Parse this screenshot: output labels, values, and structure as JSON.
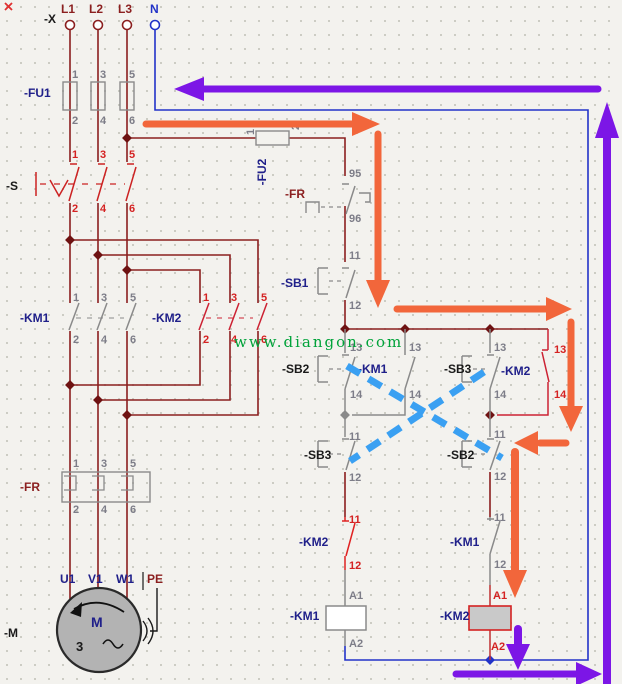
{
  "supply": {
    "x_label": "-X",
    "l1": "L1",
    "l2": "L2",
    "l3": "L3",
    "n": "N"
  },
  "fu1": {
    "label": "-FU1",
    "pins_top": [
      "1",
      "3",
      "5"
    ],
    "pins_bottom": [
      "2",
      "4",
      "6"
    ]
  },
  "s": {
    "label": "-S",
    "pins_top": [
      "1",
      "3",
      "5"
    ],
    "pins_bottom": [
      "2",
      "4",
      "6"
    ]
  },
  "km1_main": {
    "label": "-KM1",
    "pins_top": [
      "1",
      "3",
      "5"
    ],
    "pins_bottom": [
      "2",
      "4",
      "6"
    ]
  },
  "km2_main": {
    "label": "-KM2",
    "pins_top": [
      "1",
      "3",
      "5"
    ],
    "pins_bottom": [
      "2",
      "4",
      "6"
    ]
  },
  "fr_main": {
    "label": "-FR",
    "pins_top": [
      "1",
      "3",
      "5"
    ],
    "pins_bottom": [
      "2",
      "4",
      "6"
    ]
  },
  "motor": {
    "label": "-M",
    "letter": "M",
    "phase": "3",
    "u1": "U1",
    "v1": "V1",
    "w1": "W1",
    "pe": "PE"
  },
  "fu2": {
    "label": "-FU2",
    "pin1": "1",
    "pin2": "2"
  },
  "fr_nc": {
    "label": "-FR",
    "top": "95",
    "bottom": "96"
  },
  "sb1": {
    "label": "-SB1",
    "top": "11",
    "bottom": "12"
  },
  "sb2_no": {
    "label": "-SB2",
    "top": "13",
    "bottom": "14"
  },
  "km1_aux": {
    "label": "-KM1",
    "top": "13",
    "bottom": "14"
  },
  "sb3_no": {
    "label": "-SB3",
    "top": "13",
    "bottom": "14"
  },
  "km2_aux": {
    "label": "-KM2",
    "top": "13",
    "bottom": "14"
  },
  "sb3_nc": {
    "label": "-SB3",
    "top": "11",
    "bottom": "12"
  },
  "sb2_nc": {
    "label": "-SB2",
    "top": "11",
    "bottom": "12"
  },
  "km2_nc": {
    "label": "-KM2",
    "top": "11",
    "bottom": "12"
  },
  "km1_nc": {
    "label": "-KM1",
    "top": "11",
    "bottom": "12"
  },
  "km1_coil": {
    "label": "-KM1",
    "top": "A1",
    "bottom": "A2"
  },
  "km2_coil": {
    "label": "-KM2",
    "top": "A1",
    "bottom": "A2"
  },
  "watermark": "www.diangon.com",
  "caption": {
    "text": "电动机控制线路"
  },
  "colors": {
    "power_wire": "#8b1f1f",
    "neutral_wire": "#2233c8",
    "contact_gray": "#8a8a8a",
    "km2_red": "#d42222",
    "label_navy": "#20208a",
    "flow_orange": "#f2663b",
    "flow_purple": "#7c16e6",
    "interlock_blue": "#3aa0f2",
    "watermark_green": "#00a33a",
    "motor_fill": "#b3b3b3"
  }
}
